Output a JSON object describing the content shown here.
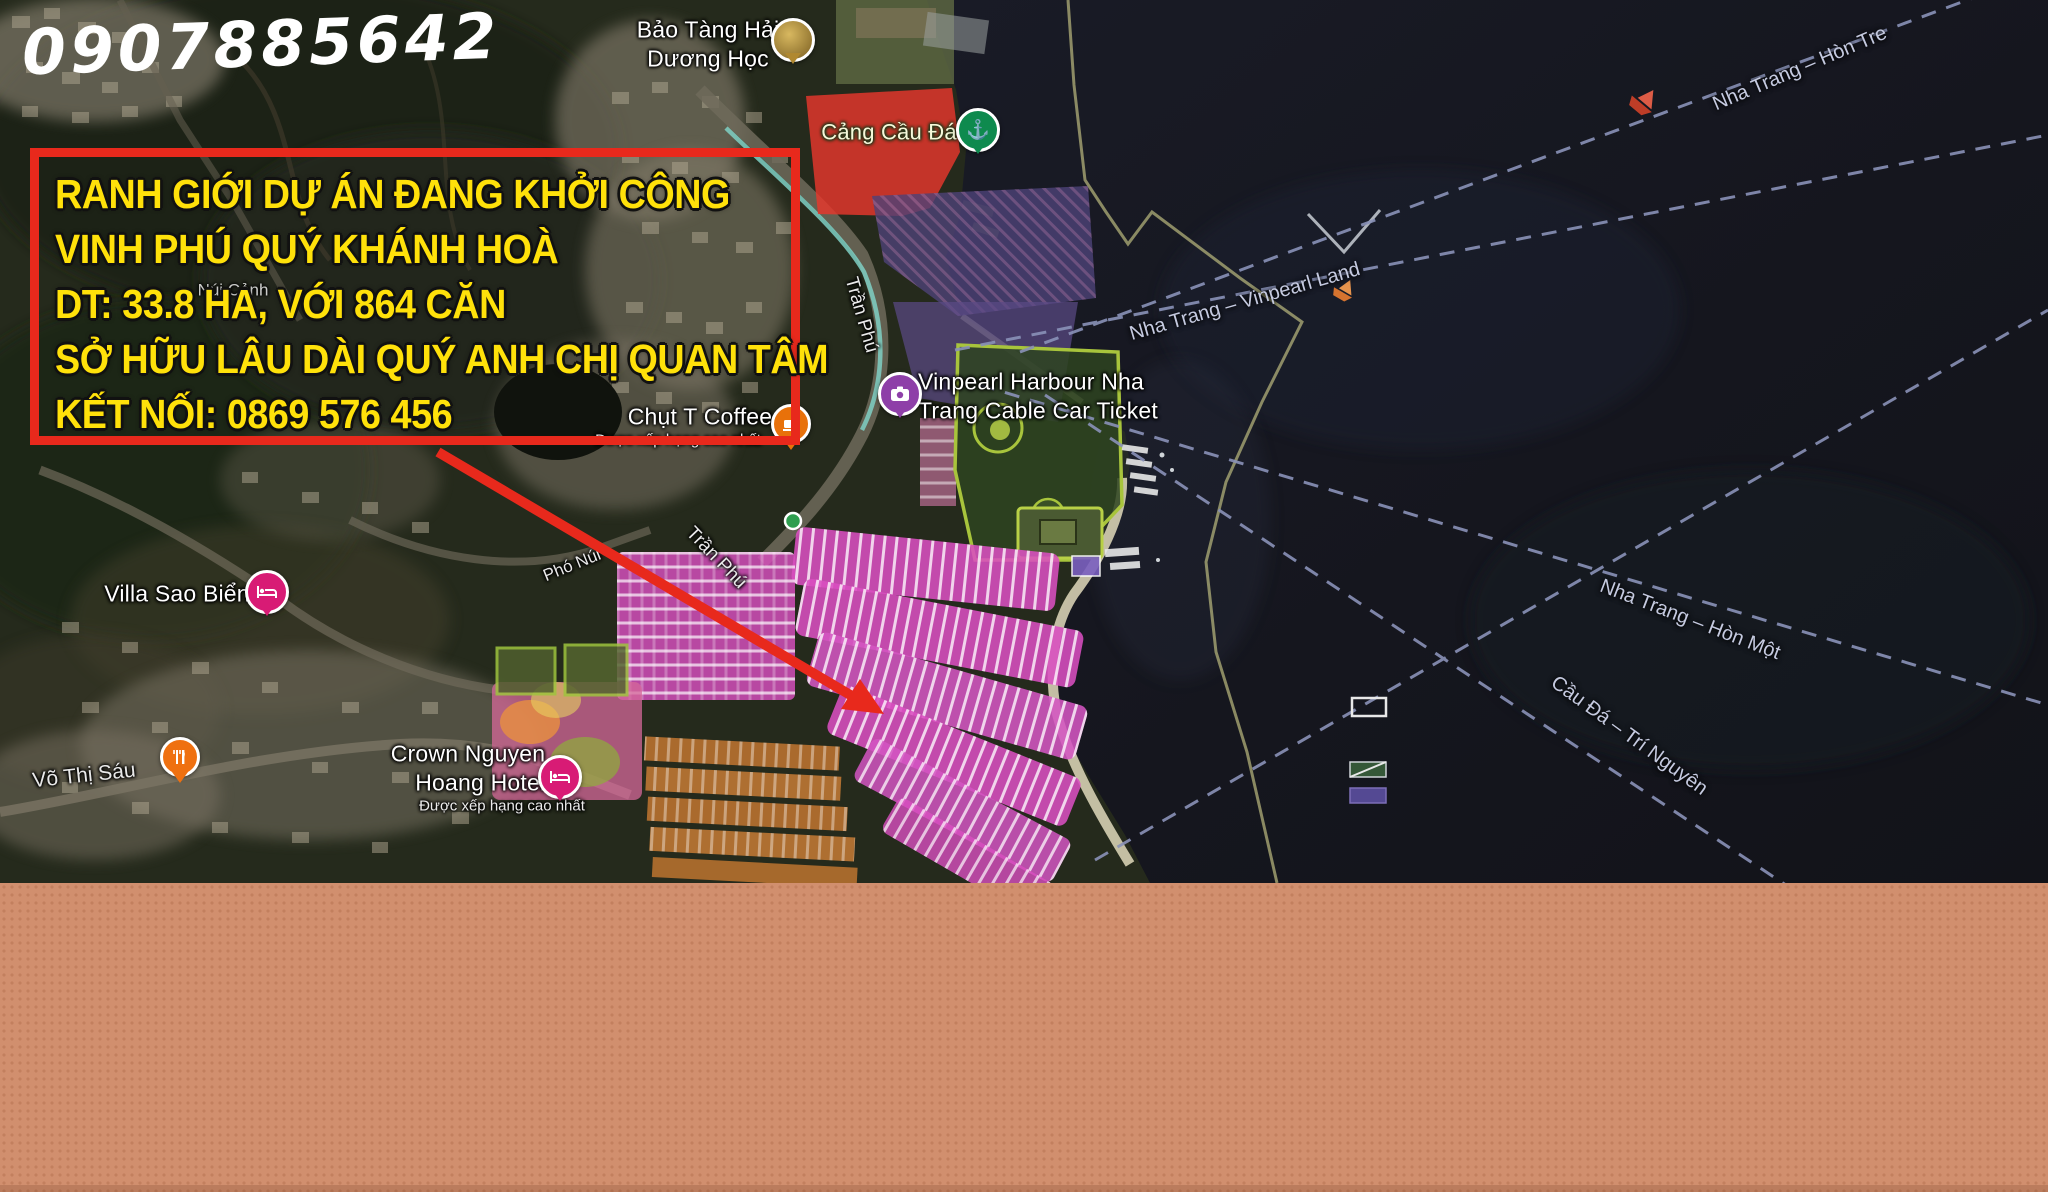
{
  "watermark": {
    "phone": "0907885642"
  },
  "callout": {
    "lines": [
      "RANH GIỚI DỰ ÁN ĐANG KHỞI CÔNG",
      "VINH PHÚ QUÝ KHÁNH HOÀ",
      "DT: 33.8 HA, VỚI 864 CĂN",
      "SỞ HỮU LÂU DÀI QUÝ ANH CHỊ QUAN TÂM",
      "KẾT NỐI: 0869 576 456"
    ],
    "border_color": "#e8291c",
    "text_color": "#ffe10a"
  },
  "map": {
    "pois": [
      {
        "id": "museum",
        "line1": "Bảo Tàng Hải",
        "line2": "Dương Học",
        "icon": "photo-circle-icon"
      },
      {
        "id": "port",
        "label": "Cảng Cầu Đá",
        "icon": "ferry-anchor-icon"
      },
      {
        "id": "vinpearl",
        "line1": "Vinpearl Harbour Nha",
        "line2": "Trang Cable Car Ticket",
        "icon": "camera-icon"
      },
      {
        "id": "coffee",
        "label": "Chụt T Coffee",
        "subtitle": "Được xếp hạng cao nhất",
        "icon": "coffee-cup-icon"
      },
      {
        "id": "villa",
        "label": "Villa Sao Biển",
        "icon": "lodging-bed-icon"
      },
      {
        "id": "hotel",
        "line1": "Crown Nguyen",
        "line2": "Hoang Hotel",
        "subtitle": "Được xếp hạng cao nhất",
        "icon": "lodging-bed-icon"
      }
    ],
    "roads": [
      {
        "id": "tran-phu-1",
        "label": "Trần Phú"
      },
      {
        "id": "tran-phu-2",
        "label": "Trần Phú"
      },
      {
        "id": "pho-nui",
        "label": "Phó Núi"
      },
      {
        "id": "vo-thi-sau",
        "label": "Võ Thị Sáu"
      },
      {
        "id": "nui-canh",
        "label": "Núi Cảnh"
      }
    ],
    "sea_routes": [
      {
        "label": "Nha Trang – Hòn Tre"
      },
      {
        "label": "Nha Trang – Vinpearl Land"
      },
      {
        "label": "Nha Trang – Hòn Một"
      },
      {
        "label": "Cầu Đá – Trí Nguyên"
      }
    ],
    "colors": {
      "sea": "#15161e",
      "land": "#252a1c",
      "lots_pink": "#d94fc0",
      "zone_red": "#e8372c",
      "zone_purple": "#5a4a85",
      "park_outline": "#a8c43c",
      "route_dash": "#8a92b8",
      "boundary_khaki": "#b2b07a"
    }
  },
  "footer": {
    "background": "#d18f6e"
  }
}
